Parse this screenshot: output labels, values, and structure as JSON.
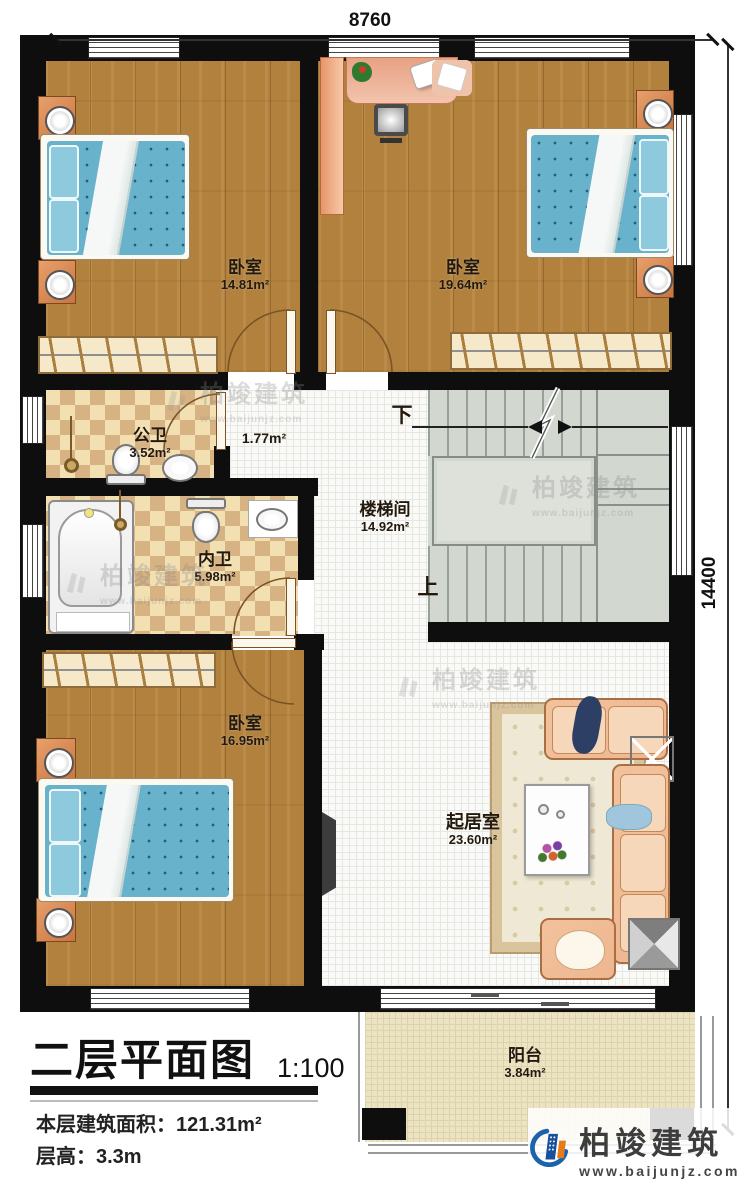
{
  "dimensions": {
    "top": "8760",
    "right": "14400"
  },
  "rooms": {
    "bedroom_top_left": {
      "name": "卧室",
      "area": "14.81m²"
    },
    "bedroom_top_right": {
      "name": "卧室",
      "area": "19.64m²"
    },
    "public_bath": {
      "name": "公卫",
      "area": "3.52m²"
    },
    "hall": {
      "area": "1.77m²"
    },
    "ensuite_bath": {
      "name": "内卫",
      "area": "5.98m²"
    },
    "stairwell": {
      "name": "楼梯间",
      "area": "14.92m²"
    },
    "bedroom_bottom": {
      "name": "卧室",
      "area": "16.95m²"
    },
    "living_room": {
      "name": "起居室",
      "area": "23.60m²"
    },
    "balcony": {
      "name": "阳台",
      "area": "3.84m²"
    }
  },
  "stairs": {
    "down_label": "下",
    "up_label": "上"
  },
  "title_block": {
    "title": "二层平面图",
    "scale": "1:100",
    "floor_area": "本层建筑面积：121.31m²",
    "floor_height": "层高：3.3m"
  },
  "brand": {
    "name": "柏竣建筑",
    "url": "www.baijunjz.com"
  },
  "watermark": {
    "name": "柏竣建筑",
    "url": "www.baijunjz.com"
  },
  "colors": {
    "wall": "#0e0e0e",
    "wood": "#b2813e",
    "bath_tile_dark": "#d7b282",
    "bath_tile_light": "#f2e0b2",
    "white_tile": "#fafaf8",
    "stairs_fill": "#d2d8d0",
    "balcony_fill": "#ece3c2",
    "bed_blue": "#68b2cc",
    "sofa_salmon": "#eeb68f",
    "brand_blue": "#1c63ad",
    "brand_orange": "#e87a1e"
  }
}
